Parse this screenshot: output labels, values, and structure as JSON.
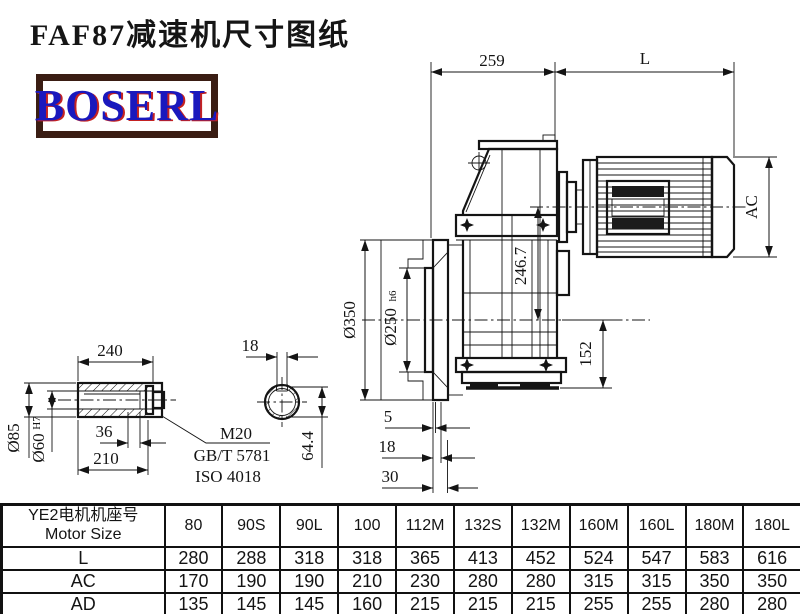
{
  "title": "FAF87减速机尺寸图纸",
  "logo": {
    "text": "BOSERL",
    "text_color": "#1a18bd",
    "shadow_color": "#c42222",
    "border_color": "#3a1d13"
  },
  "dims": {
    "top_offset": "259",
    "motor_length": "L",
    "motor_diameter": "AC",
    "center_height": "246.7",
    "flange_od": "Ø350",
    "spigot_d": "Ø250",
    "spigot_tol": "h6",
    "base_height": "152",
    "gap_5": "5",
    "gap_18": "18",
    "gap_30": "30",
    "sleeve_length": "240",
    "keyway_width": "18",
    "bore_step": "36",
    "bore_depth": "210",
    "sleeve_od": "Ø85",
    "bore_d": "Ø60",
    "bore_tol": "H7",
    "thread": "M20",
    "std_gb": "GB/T 5781",
    "std_iso": "ISO 4018",
    "keyway_depth": "64.4"
  },
  "table": {
    "header_line1": "YE2电机机座号",
    "header_line2": "Motor Size",
    "columns": [
      "80",
      "90S",
      "90L",
      "100",
      "112M",
      "132S",
      "132M",
      "160M",
      "160L",
      "180M",
      "180L"
    ],
    "rows": [
      {
        "label": "L",
        "values": [
          "280",
          "288",
          "318",
          "318",
          "365",
          "413",
          "452",
          "524",
          "547",
          "583",
          "616"
        ]
      },
      {
        "label": "AC",
        "values": [
          "170",
          "190",
          "190",
          "210",
          "230",
          "280",
          "280",
          "315",
          "315",
          "350",
          "350"
        ]
      },
      {
        "label": "AD",
        "values": [
          "135",
          "145",
          "145",
          "160",
          "215",
          "215",
          "215",
          "255",
          "255",
          "280",
          "280"
        ]
      }
    ]
  }
}
